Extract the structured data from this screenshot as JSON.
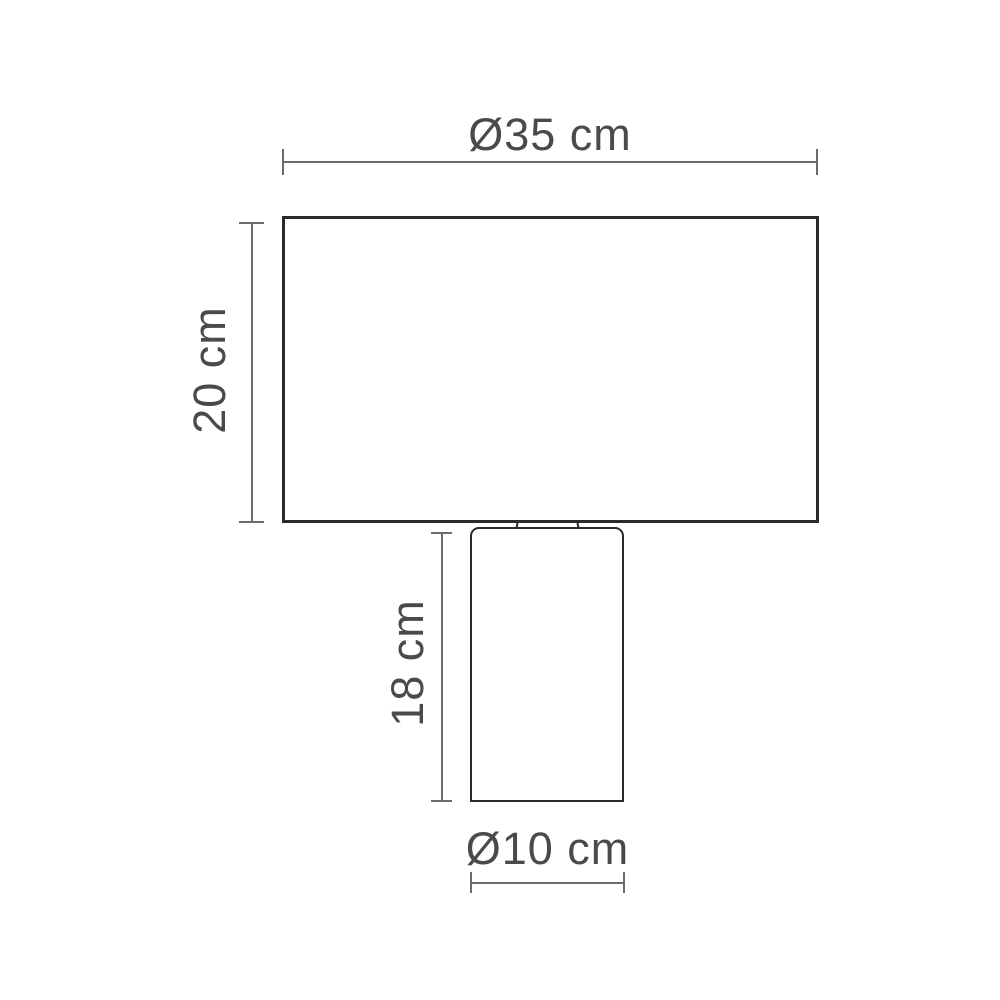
{
  "diagram": {
    "labels": {
      "shade_diameter": "Ø35 cm",
      "shade_height": "20 cm",
      "base_height": "18 cm",
      "base_diameter": "Ø10 cm"
    },
    "colors": {
      "outline": "#2b2b2b",
      "dimension_line": "#6b6b6b",
      "label_text": "#4a4a4a",
      "background": "#ffffff"
    }
  }
}
